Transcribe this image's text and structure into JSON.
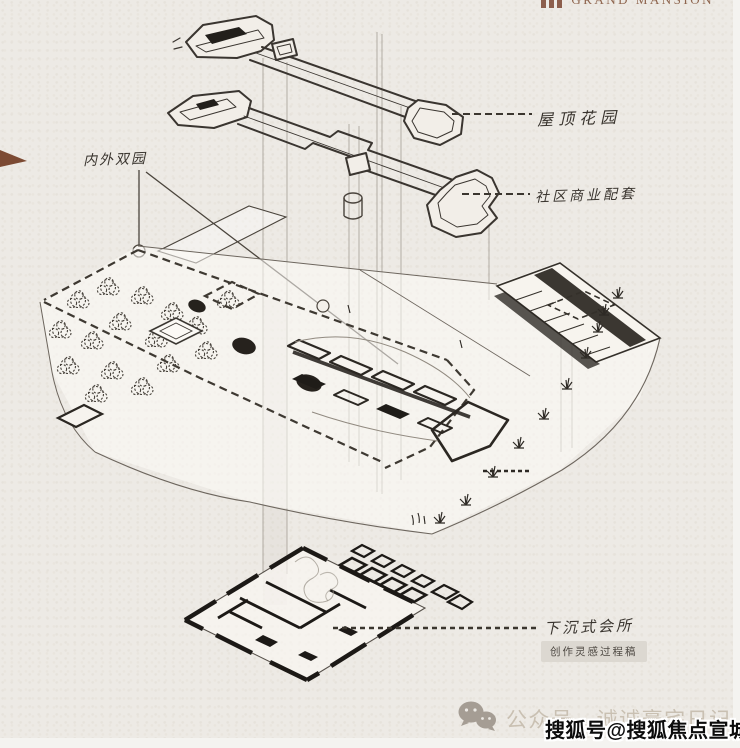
{
  "header": {
    "logo": {
      "icon": "three-bars-logo-icon",
      "text": "GRAND MANSION",
      "color": "#8d604f"
    }
  },
  "diagram": {
    "type": "exploded-axonometric-architecture-sketch",
    "paper_color": "#edeae5",
    "line_color": "#3a352f",
    "callouts": [
      {
        "id": "roof-garden",
        "text": "屋顶花园"
      },
      {
        "id": "community-commercial",
        "text": "社区商业配套"
      },
      {
        "id": "inner-outer-gardens",
        "text": "内外双园"
      },
      {
        "id": "sunken-clubhouse",
        "text": "下沉式会所"
      }
    ],
    "note": {
      "text": "创作灵感过程稿",
      "bg_color": "#dcd8d1"
    }
  },
  "footer": {
    "icon": "wechat-icon",
    "text": "公众号 · 诚诚豪宅日记",
    "color": "#c9c0b2"
  },
  "watermark": {
    "text": "搜狐号@搜狐焦点宣城站",
    "color": "#0c0c0c",
    "outline_color": "#ffffff"
  },
  "decorations": {
    "left_triangle_icon": "brown-triangle-icon",
    "triangle_color": "#7c4a33"
  }
}
